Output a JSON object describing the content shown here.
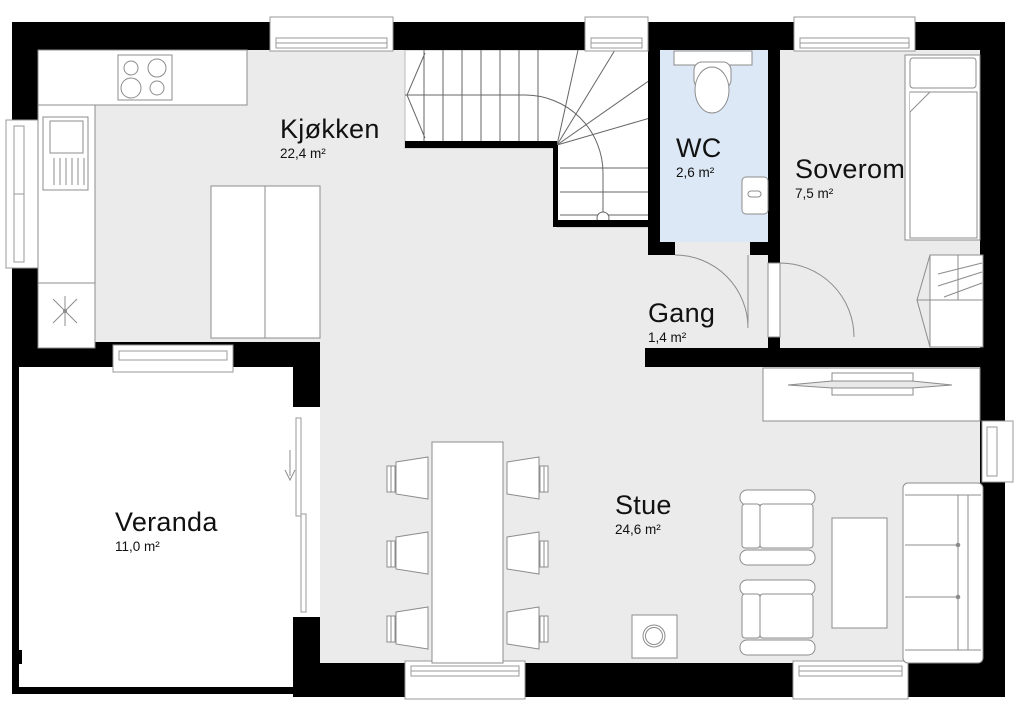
{
  "plan": {
    "rooms": [
      {
        "id": "kjokken",
        "name": "Kjøkken",
        "area": "22,4 m²"
      },
      {
        "id": "wc",
        "name": "WC",
        "area": "2,6 m²"
      },
      {
        "id": "soverom",
        "name": "Soverom",
        "area": "7,5 m²"
      },
      {
        "id": "gang",
        "name": "Gang",
        "area": "1,4 m²"
      },
      {
        "id": "stue",
        "name": "Stue",
        "area": "24,6 m²"
      },
      {
        "id": "veranda",
        "name": "Veranda",
        "area": "11,0 m²"
      }
    ],
    "colors": {
      "wall": "#000000",
      "floor": "#ebebeb",
      "wc_floor": "#dce8f5",
      "outline": "#8c8c8c",
      "stair_line": "#666666",
      "background": "#ffffff"
    },
    "fixtures": [
      "stove-top",
      "kitchen-sink-unit",
      "kitchen-counter",
      "tall-cabinet",
      "floor-drain",
      "staircase",
      "toilet",
      "wc-hand-basin",
      "bed",
      "wardrobe",
      "dining-table",
      "dining-chairs",
      "wood-stove",
      "armchairs",
      "coffee-table",
      "sofa",
      "tv-bench",
      "sliding-door",
      "hinged-doors",
      "windows"
    ]
  }
}
